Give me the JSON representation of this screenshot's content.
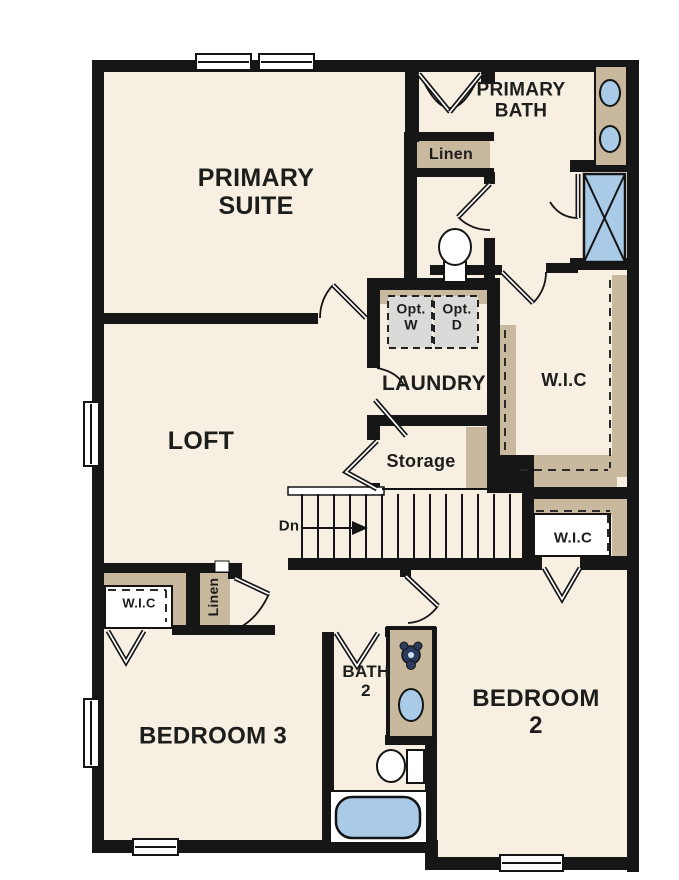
{
  "colors": {
    "floor": "#f7efe1",
    "wall": "#161616",
    "cabinet_tan": "#c8b89e",
    "fixture_blue": "#a9cbe8",
    "appliance_gray": "#dadbd8",
    "faucet_navy": "#2b3b5e",
    "label_text": "#1d1d1b"
  },
  "rooms": {
    "primary_suite": "PRIMARY\nSUITE",
    "primary_bath": "PRIMARY\nBATH",
    "loft": "LOFT",
    "laundry": "LAUNDRY",
    "storage": "Storage",
    "bedroom2": "BEDROOM 2",
    "bedroom3": "BEDROOM 3",
    "bath2": "BATH\n2"
  },
  "closets": {
    "linen_primary": "Linen",
    "linen_hall": "Linen",
    "wic_primary": "W.I.C",
    "wic_hall": "W.I.C",
    "wic_bedroom3": "W.I.C"
  },
  "stairs": {
    "direction_label": "Dn"
  },
  "appliances": {
    "washer": "Opt.\nW",
    "dryer": "Opt.\nD"
  }
}
